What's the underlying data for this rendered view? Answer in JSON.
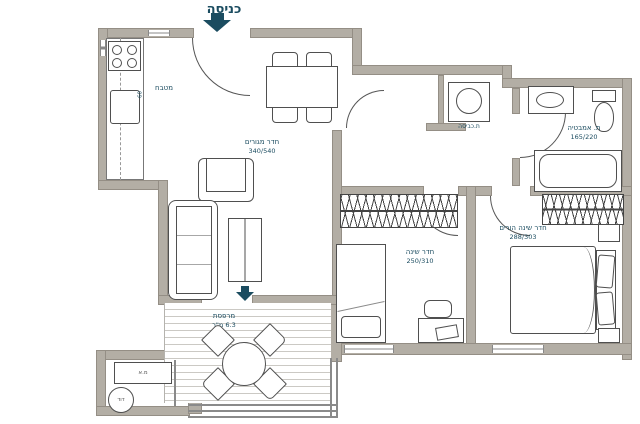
{
  "plan_title": "apartment-floor-plan",
  "colors": {
    "wall": "#b3aea5",
    "accent_teal": "#1b4c60",
    "line": "#4f4f4f",
    "deck_line": "#cbc9c4"
  },
  "entrance": {
    "label": "כניסה"
  },
  "rooms": {
    "kitchen": {
      "name": "מטבח",
      "counter_dim": "60"
    },
    "living_room": {
      "name": "חדר מגורים",
      "dims": "340/540"
    },
    "laundry": {
      "name": "ת.כביסה"
    },
    "bathroom": {
      "name": "ת. אמבטיה",
      "dims": "165/220"
    },
    "bedroom": {
      "name": "חדר שינה",
      "dims": "250/310"
    },
    "master_bedroom": {
      "name": "חדר שינה הורים",
      "dims": "288/303"
    },
    "balcony": {
      "name": "מרפסת",
      "area": "6.3 מ\"ר"
    },
    "service": {
      "ac_unit": "מ.א",
      "water_heater": "דוד"
    }
  }
}
